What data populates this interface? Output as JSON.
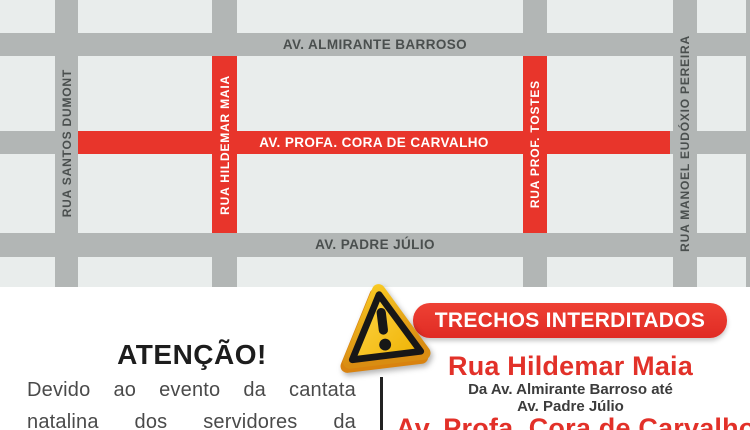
{
  "map": {
    "colors": {
      "block": "#e9edec",
      "street": "#b2b6b5",
      "closed_street": "#e8352b",
      "street_label_dark": "#4a4f4e",
      "street_label_light": "#ffffff"
    },
    "streets": {
      "almirante_barroso": "AV. ALMIRANTE BARROSO",
      "cora_de_carvalho": "AV. PROFA. CORA DE CARVALHO",
      "padre_julio": "AV. PADRE JÚLIO",
      "santos_dumont": "RUA SANTOS DUMONT",
      "hildemar_maia": "RUA HILDEMAR MAIA",
      "prof_tostes": "RUA PROF. TOSTES",
      "manoel_eudoxio_pereira": "RUA MANOEL EUDÓXIO PEREIRA"
    },
    "closed_streets": [
      "RUA HILDEMAR MAIA",
      "RUA PROF. TOSTES",
      "AV. PROFA. CORA DE CARVALHO"
    ]
  },
  "notice": {
    "title": "ATENÇÃO!",
    "body_lines": [
      "Devido ao evento da cantata",
      "natalina dos servidores da"
    ]
  },
  "closures": {
    "banner_label": "TRECHOS INTERDITADOS",
    "accent_color": "#e23129",
    "items": [
      {
        "name": "Rua Hildemar Maia",
        "details": [
          "Da Av. Almirante Barroso até",
          "Av. Padre Júlio"
        ]
      },
      {
        "name": "Av. Profa. Cora de Carvalho",
        "details": []
      }
    ]
  }
}
